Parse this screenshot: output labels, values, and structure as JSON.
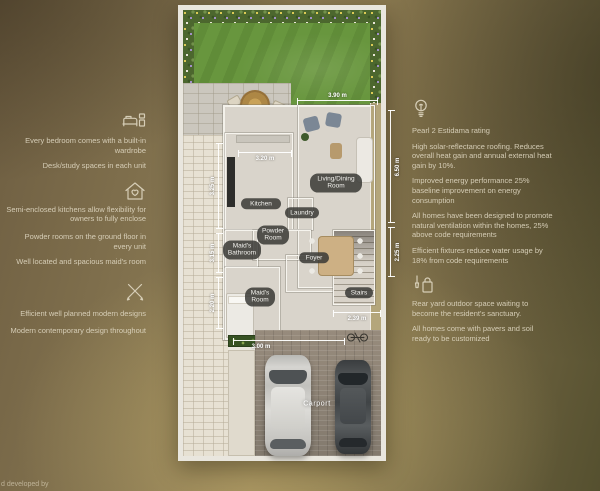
{
  "footer": {
    "developed_by": "d developed by"
  },
  "left": {
    "items": [
      "Every bedroom comes with a built-in wardrobe",
      "Desk/study spaces in each unit",
      "Semi-enclosed kitchens allow flexibility for owners to fully enclose",
      "Powder rooms on the ground floor in every unit",
      "Well located and spacious maid's room",
      "Efficient well planned modern designs",
      "Modern contemporary design throughout"
    ]
  },
  "right": {
    "items": [
      "Pearl 2 Estidama rating",
      "High solar-reflectance roofing. Reduces overall heat gain and annual external heat gain by 10%.",
      "Improved energy performance 25% baseline improvement on energy consumption",
      "All homes have been designed to promote natural ventilation within the homes, 25% above code requirements",
      "Efficient fixtures reduce water usage by 18% from code requirements",
      "Rear yard outdoor space waiting to become the resident's sanctuary.",
      "All homes come with pavers and soil ready to be customized"
    ]
  },
  "plan": {
    "rooms": {
      "kitchen": "Kitchen",
      "living": "Living/Dining Room",
      "laundry": "Laundry",
      "powder": "Powder Room",
      "maids_bath": "Maid's Bathroom",
      "foyer": "Foyer",
      "maids_room": "Maid's Room",
      "stairs": "Stairs",
      "carport": "Carport"
    },
    "dimensions": {
      "garden_width": "3.90 m",
      "kitchen_width": "3.20 m",
      "kitchen_depth": "3.25 m",
      "bath_depth": "3.15 m",
      "maids_room_depth": "2.20 m",
      "living_depth": "6.50 m",
      "stairs_depth": "2.25 m",
      "stairs_width": "2.39 m",
      "house_width": "3.00 m"
    },
    "colors": {
      "lawn": "#68963e",
      "driveway": "#8e8478",
      "annotation_text": "#ded6c0"
    }
  }
}
